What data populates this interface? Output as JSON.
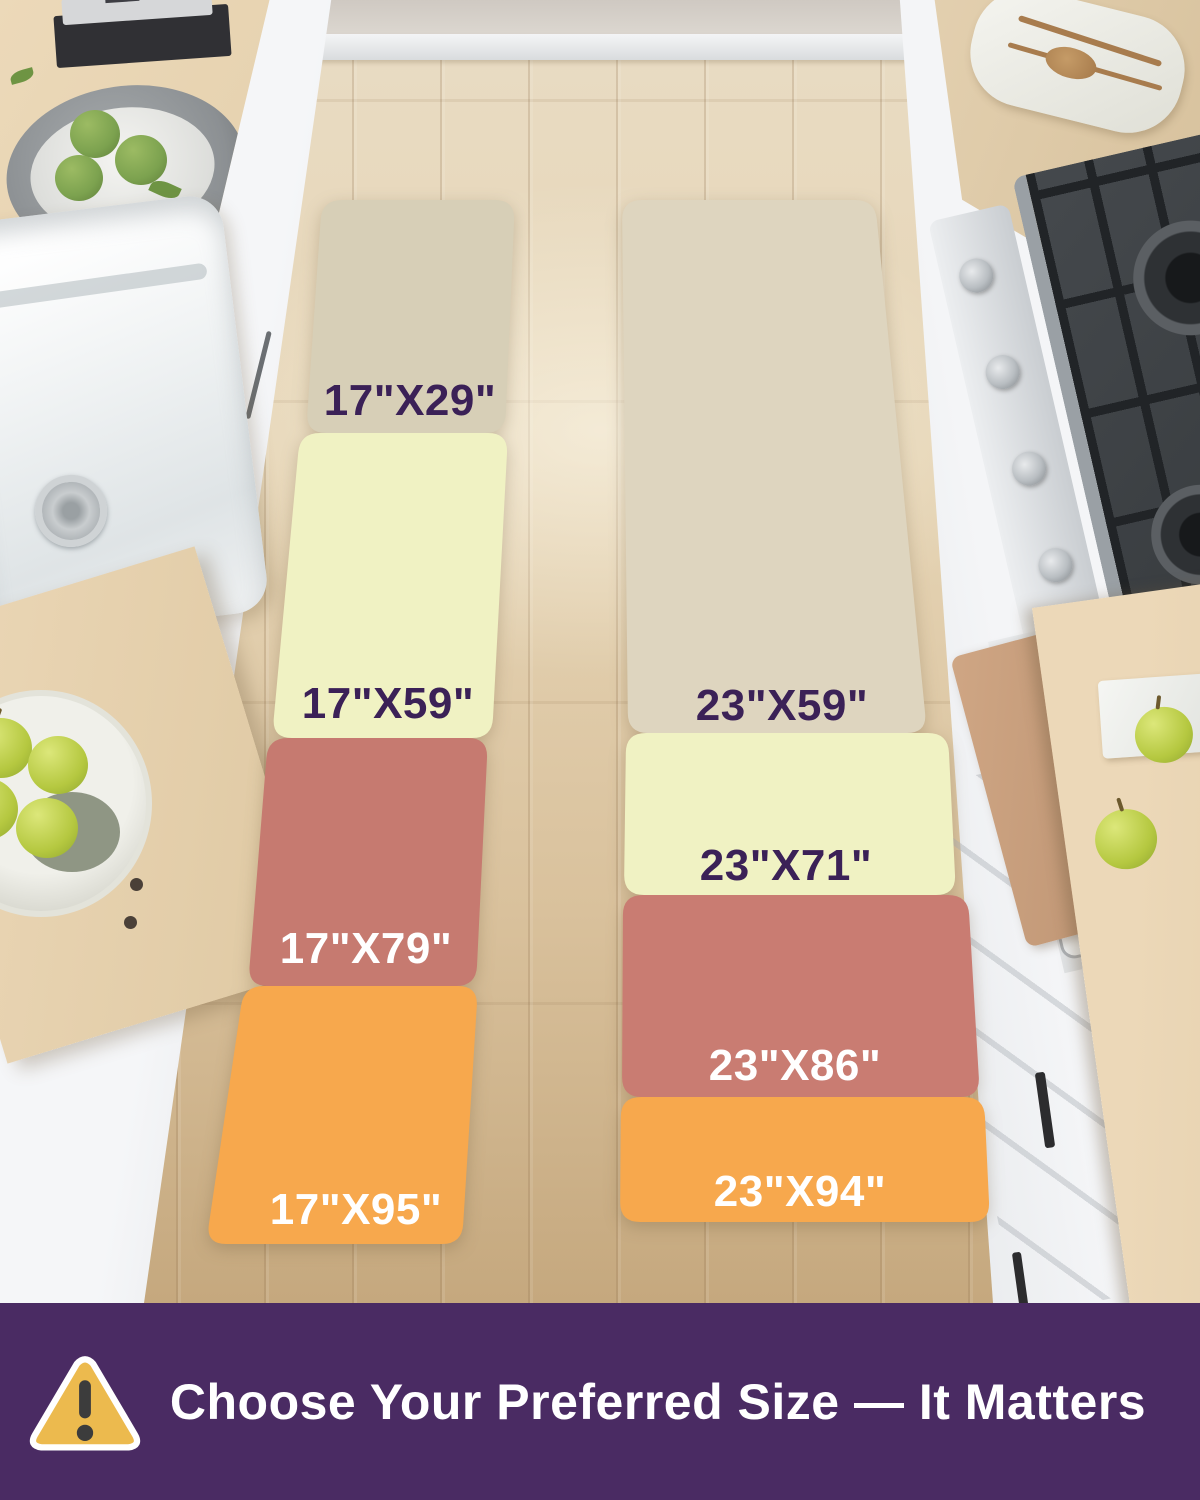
{
  "size_overlay": {
    "left_column": {
      "mats": [
        {
          "label": "17\"X29\"",
          "color": "#d7cfb7",
          "label_color": "#3b2157"
        },
        {
          "label": "17\"X59\"",
          "color": "#f0f2c3",
          "label_color": "#3b2157"
        },
        {
          "label": "17\"X79\"",
          "color": "#c67a70",
          "label_color": "#ffffff"
        },
        {
          "label": "17\"X95\"",
          "color": "#f7a84d",
          "label_color": "#ffffff"
        }
      ]
    },
    "right_column": {
      "mats": [
        {
          "label": "23\"X59\"",
          "color": "#ded5bf",
          "label_color": "#3b2157"
        },
        {
          "label": "23\"X71\"",
          "color": "#f0f2c3",
          "label_color": "#3b2157"
        },
        {
          "label": "23\"X86\"",
          "color": "#c97c72",
          "label_color": "#ffffff"
        },
        {
          "label": "23\"X94\"",
          "color": "#f7a84d",
          "label_color": "#ffffff"
        }
      ]
    }
  },
  "banner": {
    "text": "Choose Your Preferred Size — It Matters",
    "text_color": "#ffffff",
    "background": "#4a2b63",
    "icon": "warning-triangle-icon",
    "icon_fill": "#ecba4e",
    "icon_border": "#ffffff",
    "icon_glyph_color": "#3c3c3c"
  },
  "palette": {
    "floor_wood": "#dcc49e",
    "counter_wood": "#e4d0ae",
    "cabinet_white": "#f1f3f5",
    "stove_dark": "#3b3f42",
    "apple_green": "#b5c840"
  }
}
